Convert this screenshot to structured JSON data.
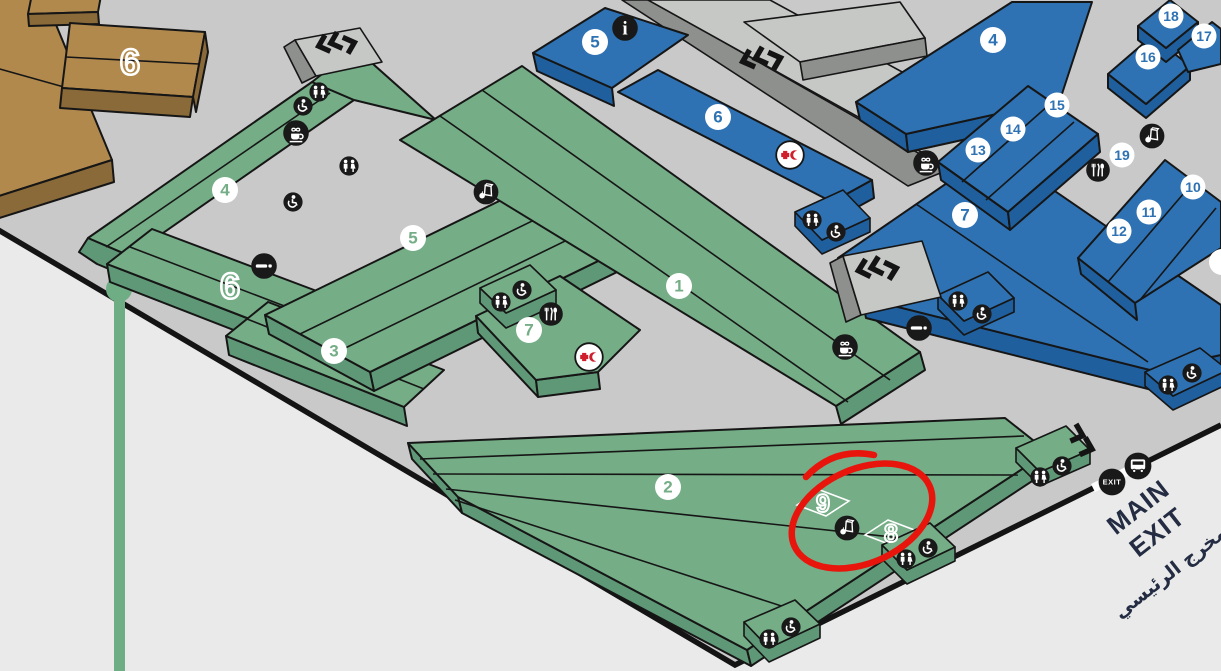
{
  "map_title": "exhibition-halls-isometric-map",
  "halls": {
    "green": [
      {
        "label": "4"
      },
      {
        "label": "5"
      },
      {
        "label": "3"
      },
      {
        "label": "1"
      },
      {
        "label": "7"
      },
      {
        "label": "2"
      }
    ],
    "green_outline": [
      {
        "label": "6"
      },
      {
        "label": "9"
      },
      {
        "label": "8"
      }
    ],
    "brown_outline": [
      {
        "label": "6"
      }
    ],
    "blue": [
      {
        "label": "5"
      },
      {
        "label": "6"
      },
      {
        "label": "4"
      },
      {
        "label": "7"
      },
      {
        "label": "13"
      },
      {
        "label": "14"
      },
      {
        "label": "15"
      },
      {
        "label": "16"
      },
      {
        "label": "17"
      },
      {
        "label": "18"
      },
      {
        "label": "19"
      },
      {
        "label": "10"
      },
      {
        "label": "11"
      },
      {
        "label": "12"
      }
    ]
  },
  "exit": {
    "line1": "MAIN",
    "line2": "EXIT",
    "arabic": "المخرج الرئيسي",
    "badge": "EXIT"
  },
  "info_badge": {
    "label": "i"
  },
  "icon_types": {
    "toilets-icon": "two person silhouettes",
    "wheelchair-icon": "accessible wheelchair",
    "cafe-icon": "hot drink cup with steam",
    "smoking-icon": "cigarette",
    "restaurant-icon": "fork knife spoon",
    "food-bag-icon": "snack bag with apple",
    "info-icon": "letter i",
    "first-aid-icon": "red cross and red crescent",
    "exit-icon": "EXIT roundel",
    "bus-icon": "shuttle bus",
    "escalator-icon": "double chevrons"
  },
  "annotation": {
    "shape": "hand-drawn red circle around halls 9 and 8"
  },
  "colors": {
    "green_hall": "#74ad86",
    "green_side": "#5f9876",
    "blue_hall": "#2e72b3",
    "blue_side": "#1f5f9e",
    "brown_hall": "#b1894d",
    "brown_side": "#8a6a39",
    "ground": "#c8c9c8",
    "outside": "#e9eae9",
    "badge_black": "#191919",
    "annotation_red": "#e8150d",
    "exit_text": "#232c42",
    "first_aid_red": "#cf1f2d"
  }
}
